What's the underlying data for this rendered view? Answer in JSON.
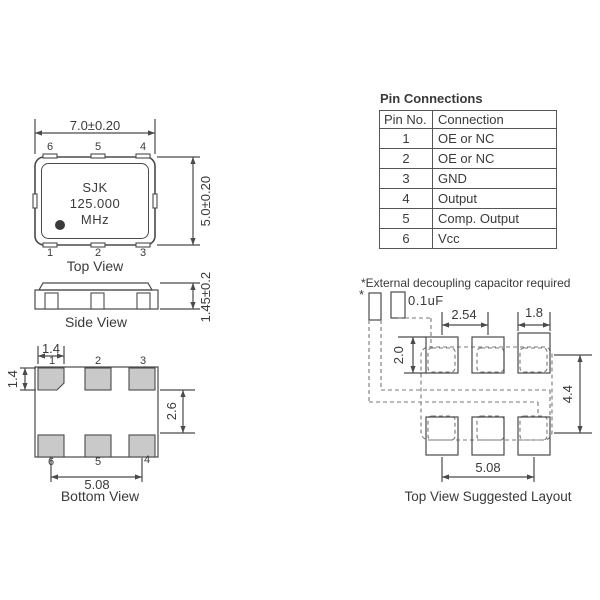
{
  "top_view": {
    "label": "Top View",
    "width_dim": "7.0±0.20",
    "height_dim": "5.0±0.20",
    "marking": [
      "SJK",
      "125.000",
      "MHz"
    ],
    "pins_top": [
      "6",
      "5",
      "4"
    ],
    "pins_bottom": [
      "1",
      "2",
      "3"
    ]
  },
  "side_view": {
    "label": "Side View",
    "height_dim": "1.45±0.2"
  },
  "bottom_view": {
    "label": "Bottom View",
    "pad_width_dim": "1.4",
    "pad_height_dim": "1.4",
    "row_gap_dim": "2.6",
    "span_dim": "5.08",
    "pins_top": [
      "1",
      "2",
      "3"
    ],
    "pins_bottom": [
      "6",
      "5",
      "4"
    ]
  },
  "pin_table": {
    "title": "Pin Connections",
    "headers": [
      "Pin No.",
      "Connection"
    ],
    "rows": [
      {
        "pin": "1",
        "connection": "OE or NC"
      },
      {
        "pin": "2",
        "connection": "OE or NC"
      },
      {
        "pin": "3",
        "connection": "GND"
      },
      {
        "pin": "4",
        "connection": "Output"
      },
      {
        "pin": "5",
        "connection": "Comp. Output"
      },
      {
        "pin": "6",
        "connection": "Vcc"
      }
    ]
  },
  "layout": {
    "note": "*External decoupling capacitor required",
    "label": "Top View Suggested Layout",
    "capacitor_marker": "*",
    "capacitor_value": "0.1uF",
    "pitch_dim": "2.54",
    "pad_width_dim": "1.8",
    "pad_height_dim": "2.0",
    "row_span_dim": "4.4",
    "col_span_dim": "5.08"
  },
  "colors": {
    "line": "#4a4a4a",
    "pad_fill": "#c9c9c9",
    "text": "#3a3a3a"
  }
}
